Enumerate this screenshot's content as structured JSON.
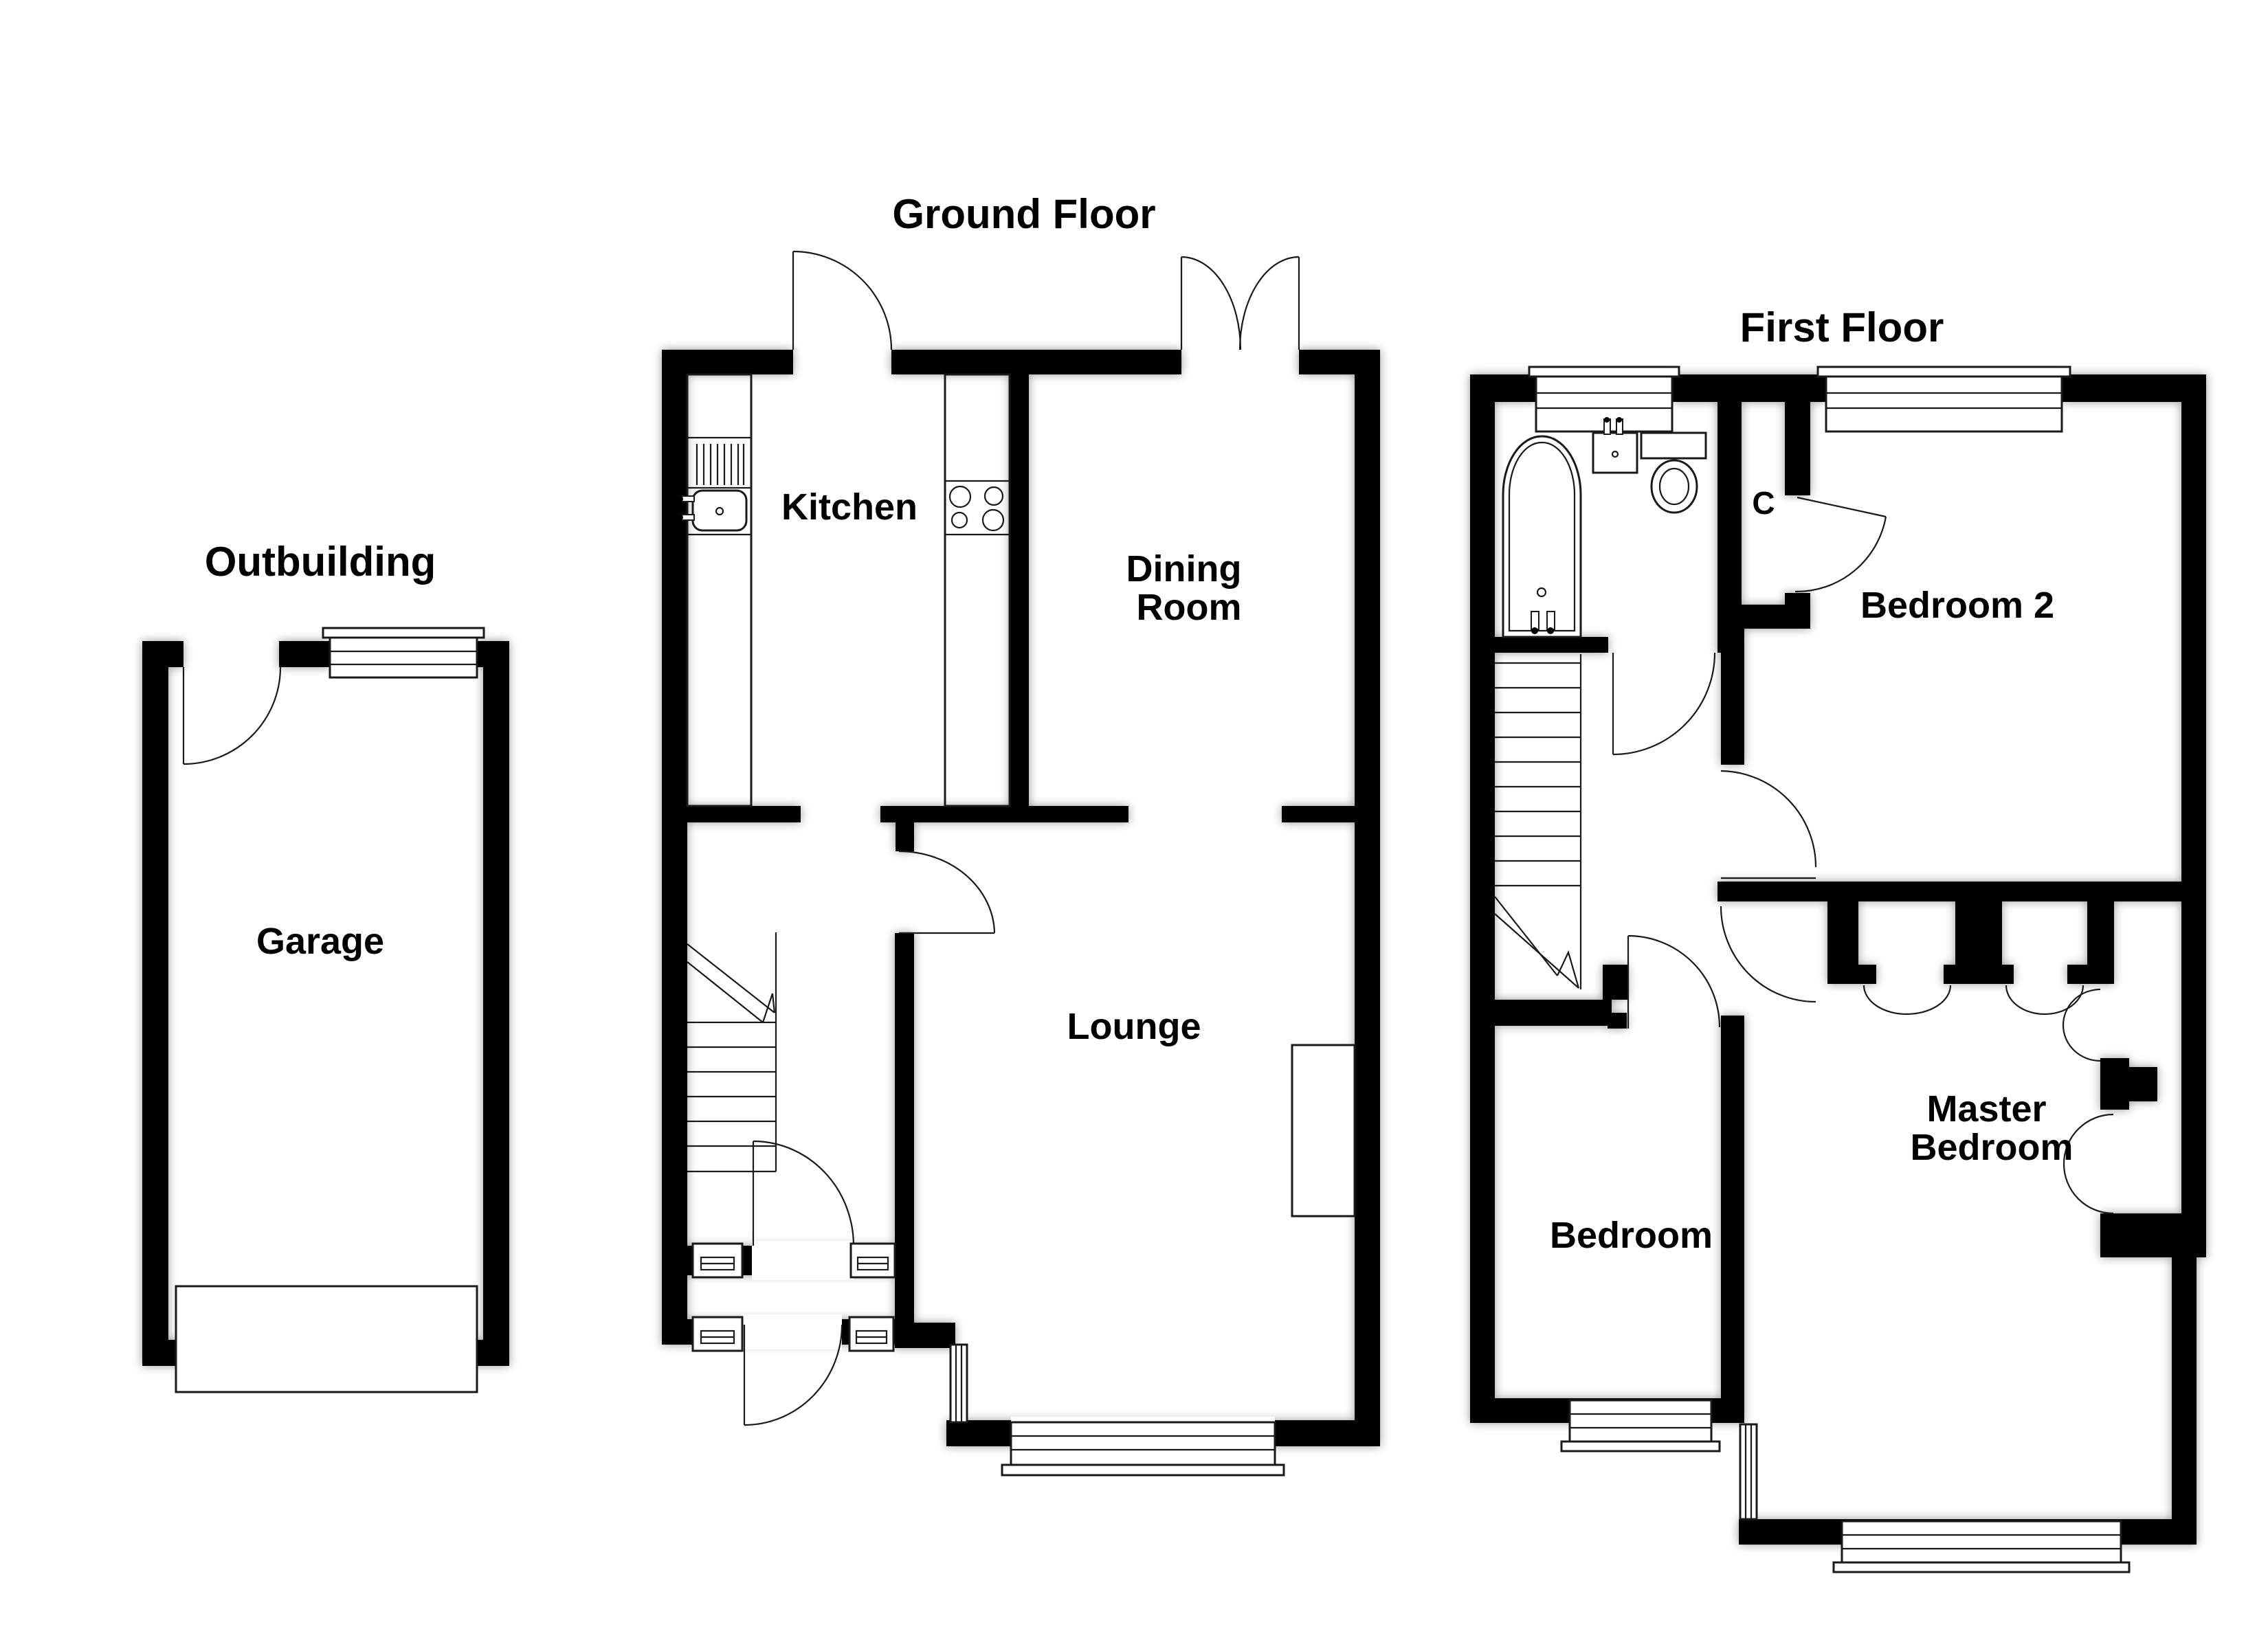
{
  "document": {
    "type": "estate-agent-floor-plan"
  },
  "colors": {
    "wall": "#000000",
    "background": "#ffffff",
    "line": "#1a1a1a"
  },
  "floors": {
    "outbuilding": {
      "title": "Outbuilding",
      "rooms": {
        "garage": {
          "label": "Garage"
        }
      },
      "features": [
        "entrance-door",
        "window",
        "garage-door"
      ]
    },
    "ground_floor": {
      "title": "Ground Floor",
      "rooms": {
        "kitchen": {
          "label": "Kitchen"
        },
        "dining_room": {
          "label_line1": "Dining",
          "label_line2": "Room"
        },
        "lounge": {
          "label": "Lounge"
        }
      },
      "fixtures": [
        "sink",
        "drainer",
        "hob",
        "stairs",
        "fireplace",
        "porch-windows",
        "front-door",
        "french-doors",
        "back-door"
      ]
    },
    "first_floor": {
      "title": "First Floor",
      "rooms": {
        "bedroom2": {
          "label": "Bedroom 2"
        },
        "bedroom3": {
          "label": "Bedroom 3"
        },
        "master_bedroom": {
          "label_line1": "Master",
          "label_line2": "Bedroom"
        },
        "closet": {
          "label": "C"
        }
      },
      "fixtures": [
        "bathtub",
        "basin",
        "toilet",
        "stairs",
        "built-in-closets",
        "windows"
      ]
    }
  }
}
